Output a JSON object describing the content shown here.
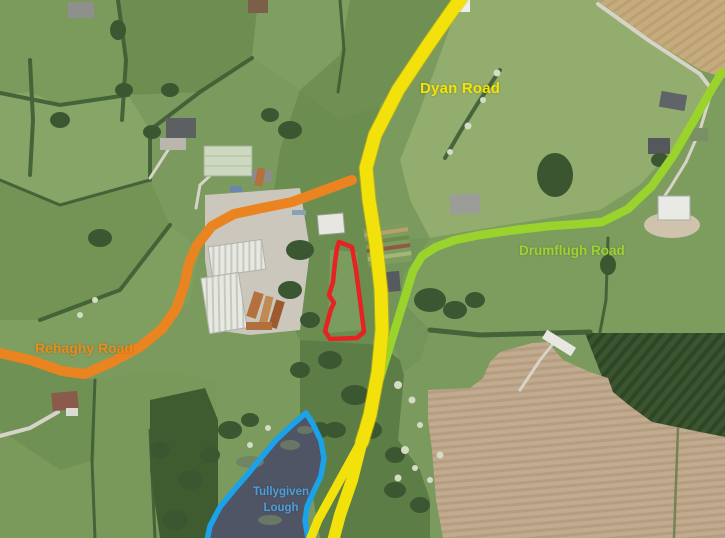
{
  "map": {
    "type": "annotated-aerial-map",
    "description": "Aerial photograph of rural townland with colour-coded road routes, lough outline and highlighted site boundary"
  },
  "labels": {
    "dyan_road": {
      "text": "Dyan Road",
      "color": "#F6E400"
    },
    "drumflugh_road": {
      "text": "Drumflugh Road",
      "color": "#9CD42F"
    },
    "rehaghy_road": {
      "text": "Rehaghy Road",
      "color": "#EE8A1A"
    },
    "tullygiven_lough": {
      "line1": "Tullygiven",
      "line2": "Lough",
      "color": "#4C9FD8"
    }
  },
  "overlays": {
    "dyan_road_route": {
      "color": "#F2E10A"
    },
    "rehaghy_road_route": {
      "color": "#EA8420"
    },
    "drumflugh_road_route": {
      "color": "#99D32C"
    },
    "lough_outline": {
      "color": "#1CA2E9"
    },
    "highlighted_site_boundary": {
      "color": "#E62222"
    }
  }
}
